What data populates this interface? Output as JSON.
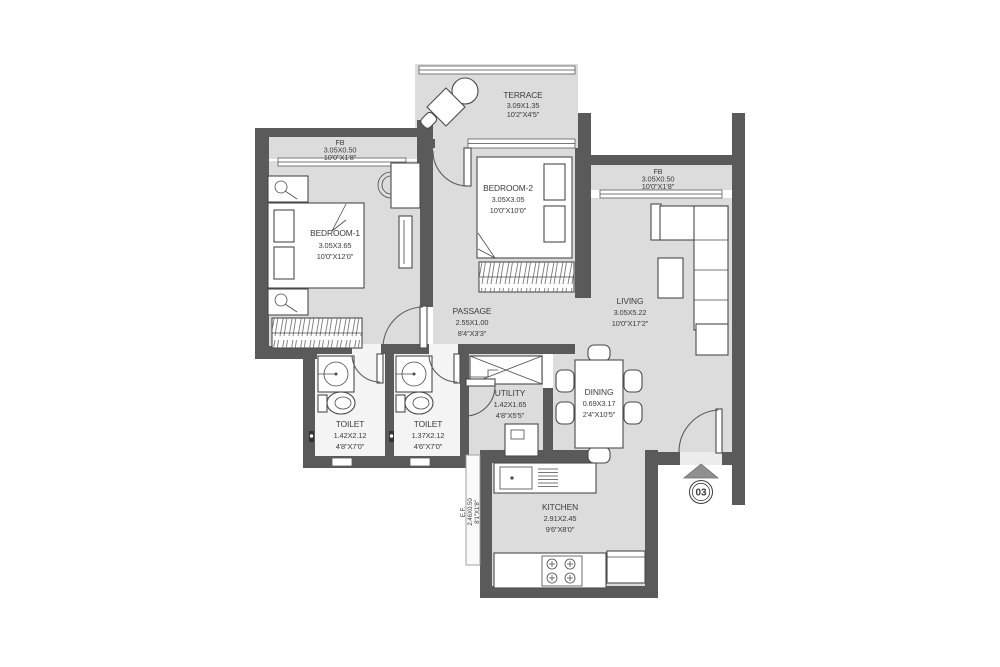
{
  "rooms": {
    "terrace": {
      "name": "TERRACE",
      "metric": "3.09X1.35",
      "imperial": "10'2\"X4'5\""
    },
    "fb_left": {
      "name": "FB",
      "metric": "3.05X0.50",
      "imperial": "10'0\"X1'8\""
    },
    "bedroom1": {
      "name": "BEDROOM-1",
      "metric": "3.05X3.65",
      "imperial": "10'0\"X12'0\""
    },
    "bedroom2": {
      "name": "BEDROOM-2",
      "metric": "3.05X3.05",
      "imperial": "10'0\"X10'0\""
    },
    "fb_right": {
      "name": "FB",
      "metric": "3.05X0.50",
      "imperial": "10'0\"X1'8\""
    },
    "living": {
      "name": "LIVING",
      "metric": "3.05X5.22",
      "imperial": "10'0\"X17'2\""
    },
    "passage": {
      "name": "PASSAGE",
      "metric": "2.55X1.00",
      "imperial": "8'4\"X3'3\""
    },
    "toilet1": {
      "name": "TOILET",
      "metric": "1.42X2.12",
      "imperial": "4'8\"X7'0\""
    },
    "toilet2": {
      "name": "TOILET",
      "metric": "1.37X2.12",
      "imperial": "4'6\"X7'0\""
    },
    "utility": {
      "name": "UTILITY",
      "metric": "1.42X1.65",
      "imperial": "4'8\"X5'5\""
    },
    "dining": {
      "name": "DINING",
      "metric": "0.69X3.17",
      "imperial": "2'4\"X10'5\""
    },
    "kitchen": {
      "name": "KITCHEN",
      "metric": "2.91X2.45",
      "imperial": "9'6\"X8'0\""
    },
    "ef": {
      "name": "E.F.",
      "metric": "2.46X0.50",
      "imperial": "8'1\"X1'8\""
    }
  },
  "entry": {
    "unit_number": "03"
  },
  "colors": {
    "wall": "#5a5a5a",
    "floor": "#dcdcdc",
    "toilet_floor": "#f4f4f4",
    "line": "#4a4a4a",
    "text": "#3b3b3b",
    "entry_arrow": "#8f8f8f",
    "background": "#ffffff"
  }
}
